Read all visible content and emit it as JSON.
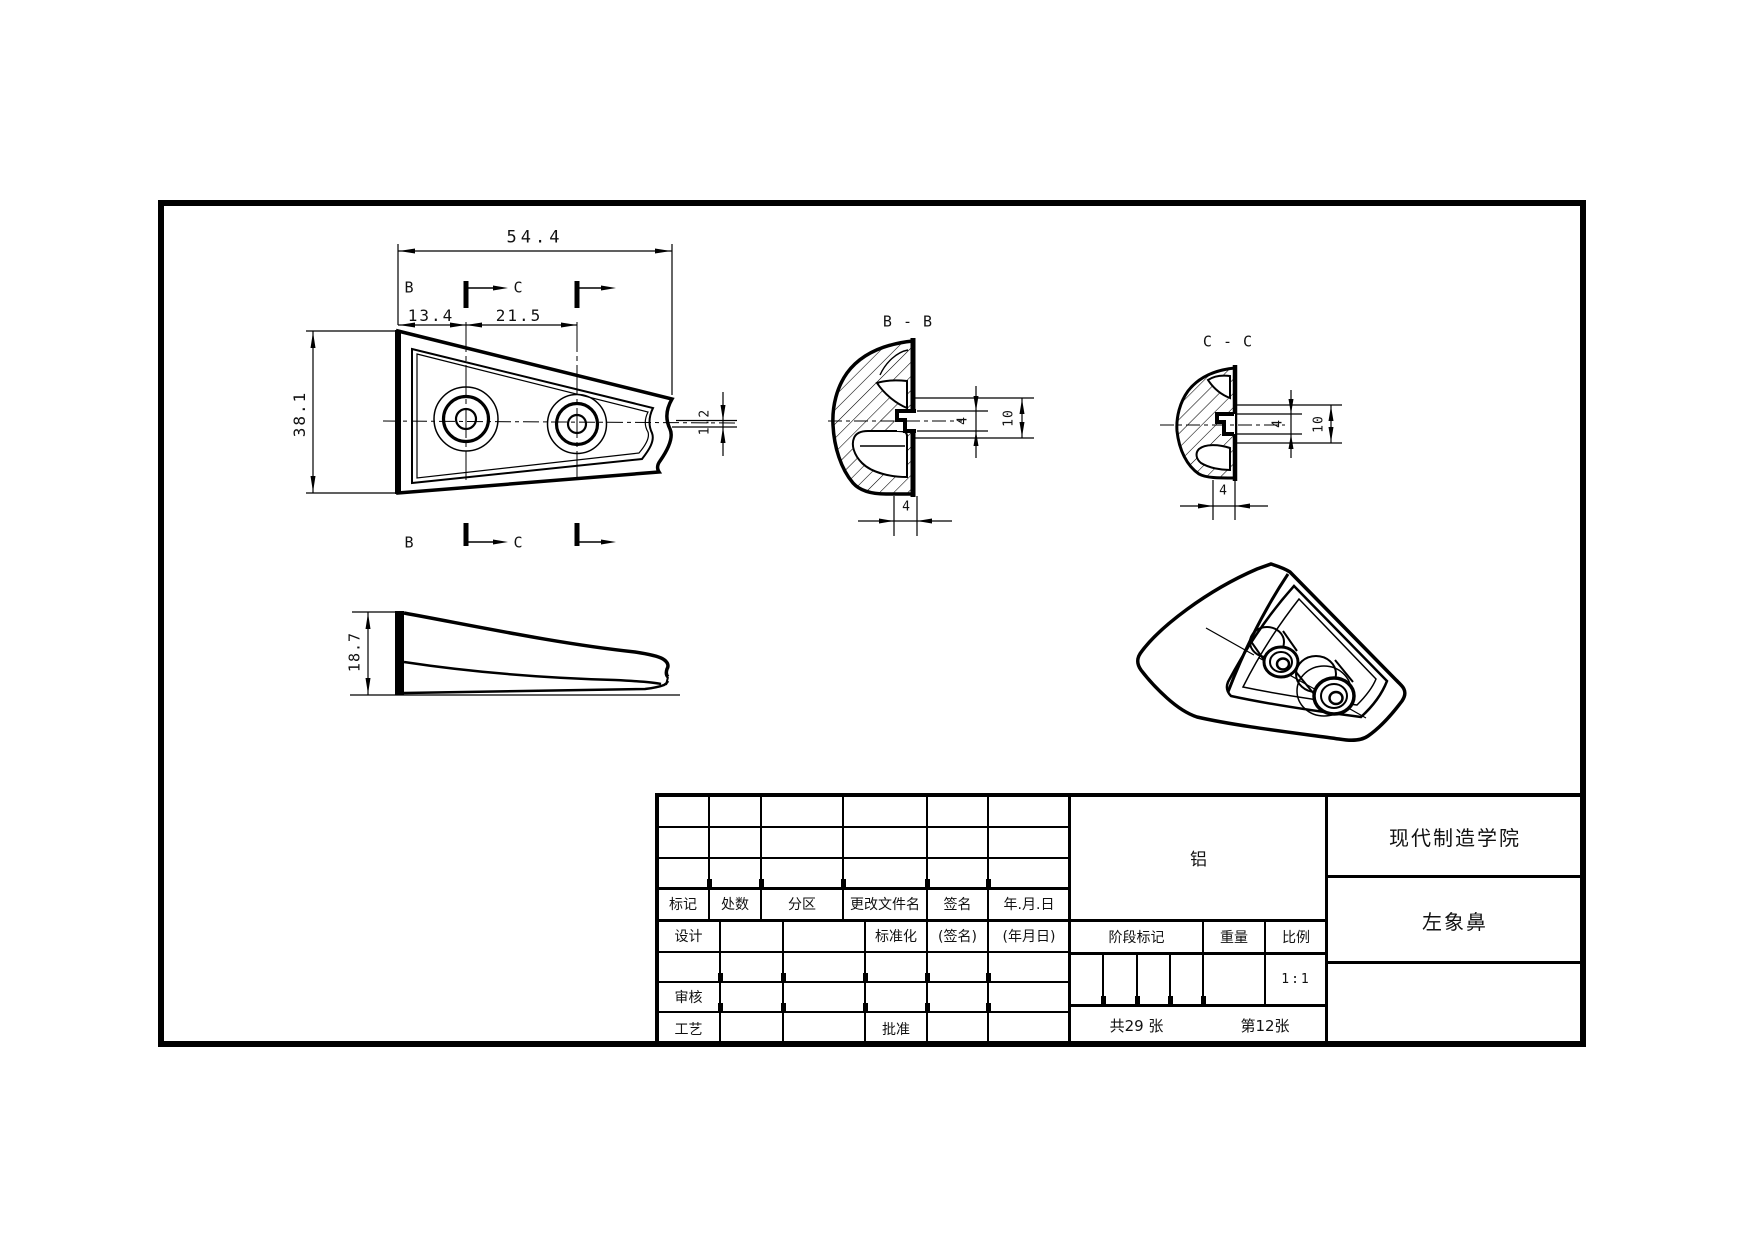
{
  "colors": {
    "line": "#000000",
    "background": "#ffffff",
    "text": "#111111"
  },
  "plan_view": {
    "dim_overall_width": "54.4",
    "dim_hole1_offset": "13.4",
    "dim_hole_spacing": "21.5",
    "dim_overall_height": "38.1",
    "dim_tip_thickness": "1.2",
    "section_label_b": "B",
    "section_label_c": "C"
  },
  "section_bb": {
    "title": "B - B",
    "dim_hole_height": "4",
    "dim_boss_height": "10",
    "dim_bottom_wall": "4"
  },
  "section_cc": {
    "title": "C - C",
    "dim_hole_height": "4",
    "dim_boss_height": "10",
    "dim_bottom_wall": "4"
  },
  "side_view": {
    "dim_height": "18.7",
    "section_label_b": "B",
    "section_label_c": "C"
  },
  "title_block": {
    "headers": {
      "mark": "标记",
      "places": "处数",
      "zone": "分区",
      "changed_file": "更改文件名",
      "signature": "签名",
      "date": "年.月.日"
    },
    "rows": {
      "design": "设计",
      "standardization": "标准化",
      "signature_hint": "(签名)",
      "date_hint": "(年月日)",
      "check": "审核",
      "process": "工艺",
      "approve": "批准"
    },
    "material": "铝",
    "stage_mark": "阶段标记",
    "weight": "重量",
    "scale": "比例",
    "scale_value": "1:1",
    "sheets_total": "共29 张",
    "sheet_number": "第12张",
    "company": "现代制造学院",
    "part_name": "左象鼻"
  }
}
